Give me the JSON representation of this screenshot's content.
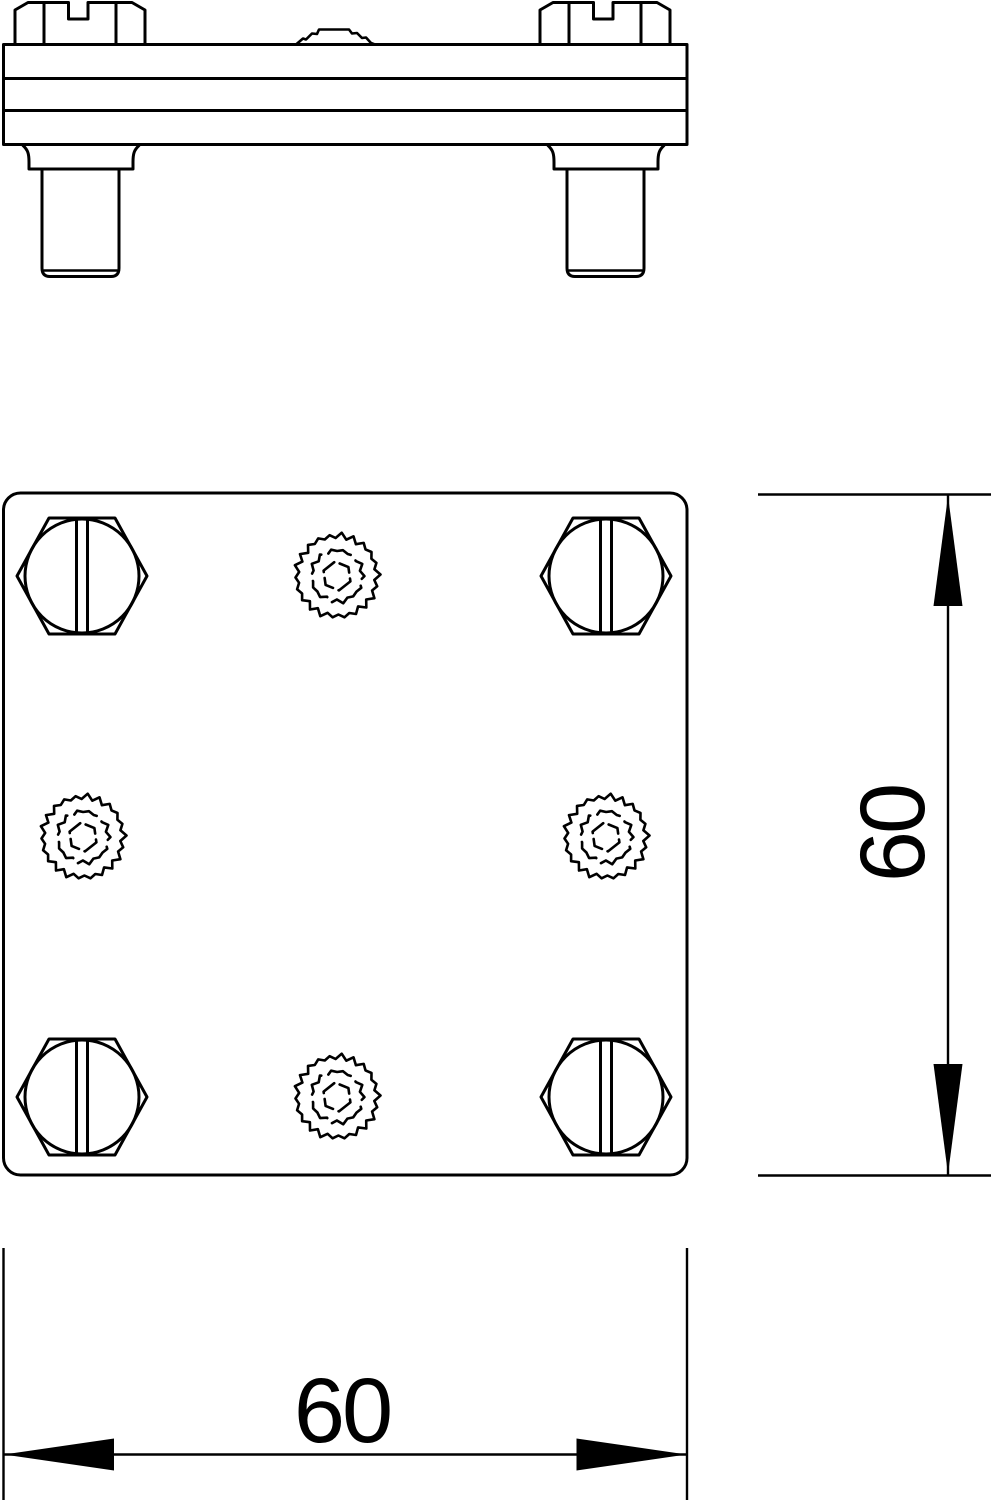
{
  "drawing": {
    "background": "#ffffff",
    "line_color": "#000000",
    "views": {
      "side_view": {
        "name": "side elevation",
        "parts": [
          "plate",
          "serrated-contact-bump",
          "screw-head-left",
          "screw-head-right",
          "threaded-stud-left",
          "threaded-stud-right"
        ]
      },
      "plan_view": {
        "name": "top view",
        "hex_bolt_count": 4,
        "serrated_contact_count": 4
      }
    },
    "dimensions": {
      "plate_width": {
        "label": "60"
      },
      "plate_height": {
        "label": "60"
      }
    }
  }
}
